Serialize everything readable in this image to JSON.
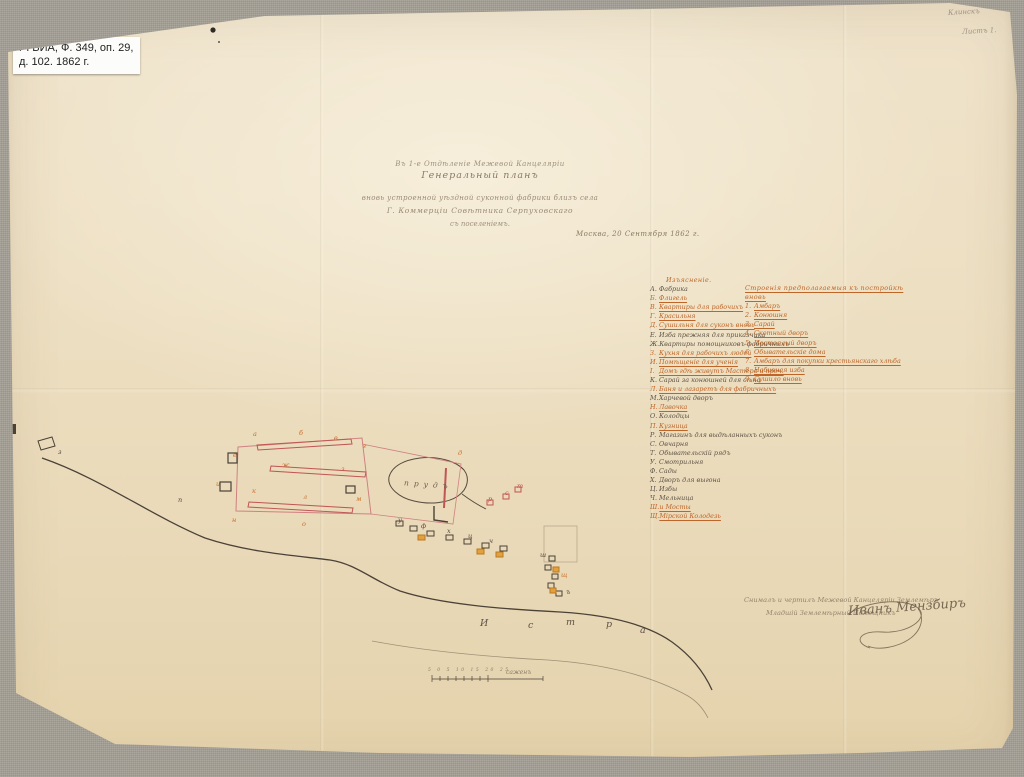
{
  "archive_label": {
    "line1": "РГВИА, Ф. 349, оп. 29,",
    "line2": "д. 102. 1862 г."
  },
  "corner_notes": {
    "note1": "Клинскъ",
    "note2": "Листъ 1."
  },
  "title_block": {
    "line1": "Въ 1-е Отдѣленіе Межевой Канцеляріи",
    "line2": "Генеральный планъ",
    "line3": "вновь устроенной уѣздной суконной фабрики близъ села",
    "line4": "Г. Коммерціи Совѣтника Серпуховскаго",
    "line5": "съ поселеніемъ.",
    "dateline": "Москва, 20 Сентября 1862 г."
  },
  "legend": {
    "left": {
      "header": "Изъясненіе.",
      "items": [
        {
          "letter": "А.",
          "text": "Фабрика",
          "orange": false
        },
        {
          "letter": "Б.",
          "text": "Флигель",
          "orange": true
        },
        {
          "letter": "В.",
          "text": "Квартиры для рабочихъ",
          "orange": true
        },
        {
          "letter": "Г.",
          "text": "Красильня",
          "orange": true
        },
        {
          "letter": "Д.",
          "text": "Сушильня для суконъ вновь",
          "orange": true
        },
        {
          "letter": "Е.",
          "text": "Изба прежняя для приказчика",
          "orange": false
        },
        {
          "letter": "Ж.",
          "text": "Квартиры помощниковъ фабричныхъ",
          "orange": false
        },
        {
          "letter": "З.",
          "text": "Кухня для рабочихъ людей",
          "orange": true
        },
        {
          "letter": "И.",
          "text": "Помѣщеніе для ученія",
          "orange": true
        },
        {
          "letter": "І.",
          "text": "Домъ гдѣ живутъ Мастера и проч.",
          "orange": true
        },
        {
          "letter": "К.",
          "text": "Сарай за конюшней для сѣна",
          "orange": false
        },
        {
          "letter": "Л.",
          "text": "Баня и лазаретъ для фабричныхъ",
          "orange": true
        },
        {
          "letter": "М.",
          "text": "Харчевой дворъ",
          "orange": false
        },
        {
          "letter": "Н.",
          "text": "Лавочка",
          "orange": true
        },
        {
          "letter": "О.",
          "text": "Колодцы",
          "orange": false
        },
        {
          "letter": "П.",
          "text": "Кузница",
          "orange": true
        },
        {
          "letter": "Р.",
          "text": "Магазинъ для выдѣланныхъ суконъ",
          "orange": false
        },
        {
          "letter": "С.",
          "text": "Овчарня",
          "orange": false
        },
        {
          "letter": "Т.",
          "text": "Обывательскій рядъ",
          "orange": false
        },
        {
          "letter": "У.",
          "text": "Смотрильня",
          "orange": false
        },
        {
          "letter": "Ф.",
          "text": "Сады",
          "orange": false
        },
        {
          "letter": "Х.",
          "text": "Дворъ для выгона",
          "orange": false
        },
        {
          "letter": "Ц.",
          "text": "Избы",
          "orange": false
        },
        {
          "letter": "Ч.",
          "text": "Мельница",
          "orange": false
        },
        {
          "letter": "Ш.",
          "text": "и Мосты",
          "orange": true
        },
        {
          "letter": "Щ.",
          "text": "Мірской Колодезь",
          "orange": true
        }
      ]
    },
    "right": {
      "header": "Строенія предполагаемыя къ постройкѣ вновь",
      "items": [
        {
          "num": "1.",
          "text": "Амбаръ"
        },
        {
          "num": "2.",
          "text": "Конюшня"
        },
        {
          "num": "3.",
          "text": "Сарай"
        },
        {
          "num": "4.",
          "text": "Скотный дворъ"
        },
        {
          "num": "5.",
          "text": "Постоялый дворъ"
        },
        {
          "num": "6.",
          "text": "Обывательскіе дома"
        },
        {
          "num": "7.",
          "text": "Амбаръ для покупки крестьянскаго хлѣба"
        },
        {
          "num": "8.",
          "text": "Набивная изба"
        },
        {
          "num": "9.",
          "text": "Сушило вновь"
        }
      ]
    }
  },
  "map": {
    "pond_label": "прудъ",
    "river": [
      {
        "t": "И",
        "x": 480,
        "y": 618
      },
      {
        "t": "с",
        "x": 528,
        "y": 620
      },
      {
        "t": "т",
        "x": 566,
        "y": 617
      },
      {
        "t": "р",
        "x": 606,
        "y": 619
      },
      {
        "t": "а",
        "x": 640,
        "y": 625
      }
    ],
    "marks": [
      {
        "t": "а",
        "x": 253,
        "y": 431,
        "c": "o"
      },
      {
        "t": "б",
        "x": 299,
        "y": 430,
        "c": "o"
      },
      {
        "t": "в",
        "x": 334,
        "y": 435,
        "c": "o"
      },
      {
        "t": "г",
        "x": 363,
        "y": 443,
        "c": "o"
      },
      {
        "t": "д",
        "x": 458,
        "y": 450,
        "c": "o"
      },
      {
        "t": "е",
        "x": 233,
        "y": 452,
        "c": "o"
      },
      {
        "t": "ж",
        "x": 282,
        "y": 462,
        "c": "o"
      },
      {
        "t": "з",
        "x": 341,
        "y": 466,
        "c": "o"
      },
      {
        "t": "и",
        "x": 216,
        "y": 481,
        "c": "o"
      },
      {
        "t": "к",
        "x": 252,
        "y": 488,
        "c": "o"
      },
      {
        "t": "л",
        "x": 303,
        "y": 494,
        "c": "o"
      },
      {
        "t": "м",
        "x": 356,
        "y": 496,
        "c": "o"
      },
      {
        "t": "н",
        "x": 232,
        "y": 517,
        "c": "o"
      },
      {
        "t": "о",
        "x": 302,
        "y": 521,
        "c": "o"
      },
      {
        "t": "п",
        "x": 178,
        "y": 497,
        "c": "k"
      },
      {
        "t": "р",
        "x": 488,
        "y": 496,
        "c": "r"
      },
      {
        "t": "с",
        "x": 505,
        "y": 490,
        "c": "r"
      },
      {
        "t": "т",
        "x": 517,
        "y": 483,
        "c": "r"
      },
      {
        "t": "у",
        "x": 398,
        "y": 517,
        "c": "k"
      },
      {
        "t": "ф",
        "x": 421,
        "y": 523,
        "c": "k"
      },
      {
        "t": "х",
        "x": 447,
        "y": 528,
        "c": "k"
      },
      {
        "t": "ц",
        "x": 468,
        "y": 533,
        "c": "k"
      },
      {
        "t": "ч",
        "x": 489,
        "y": 538,
        "c": "k"
      },
      {
        "t": "ш",
        "x": 540,
        "y": 552,
        "c": "k"
      },
      {
        "t": "щ",
        "x": 561,
        "y": 572,
        "c": "o"
      },
      {
        "t": "ъ",
        "x": 566,
        "y": 589,
        "c": "k"
      },
      {
        "t": "з",
        "x": 58,
        "y": 449,
        "c": "k"
      }
    ],
    "scale": {
      "numbers": "5 0 5 10 15 20 25",
      "unit_label": "саженъ"
    }
  },
  "signature": {
    "line1": "Снималъ и чертилъ Межевой Канцеляріи Землемѣръ",
    "line2": "Младшій Землемѣрный Помощникъ",
    "autograph": "Иванъ Мензбиръ"
  }
}
